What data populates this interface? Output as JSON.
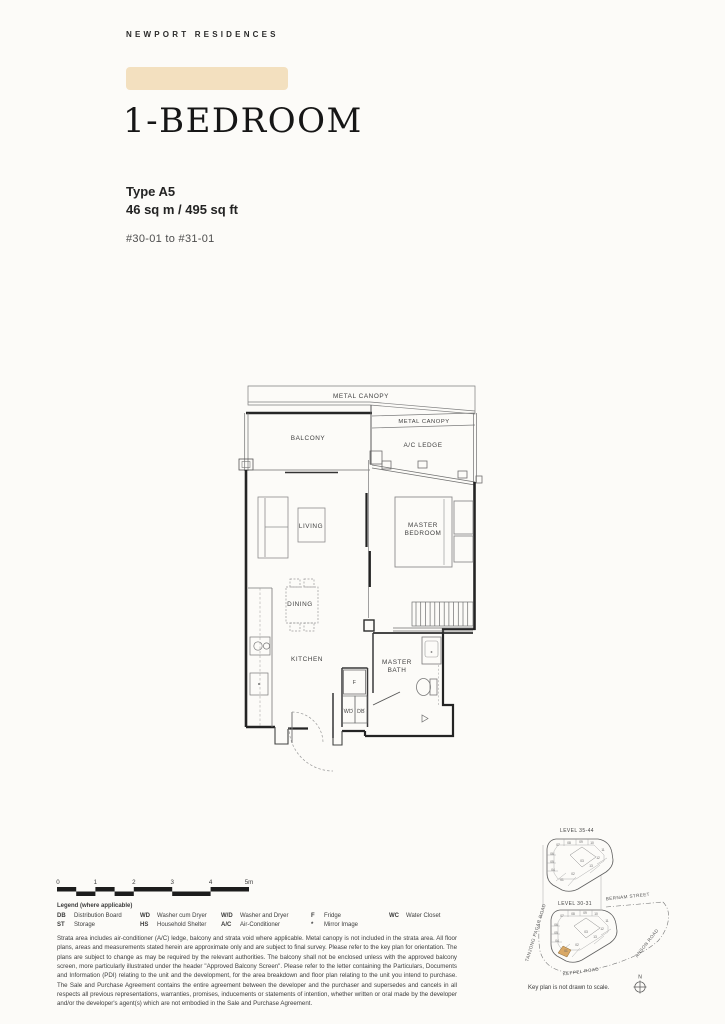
{
  "brand": "NEWPORT RESIDENCES",
  "unit": {
    "title": "1-BEDROOM",
    "type": "Type A5",
    "area": "46 sq m / 495 sq ft",
    "stacks": "#30-01 to #31-01"
  },
  "plan_labels": {
    "metal_canopy_top": "METAL CANOPY",
    "metal_canopy_2": "METAL CANOPY",
    "ac_ledge": "A/C LEDGE",
    "balcony": "BALCONY",
    "living": "LIVING",
    "master_bedroom_1": "MASTER",
    "master_bedroom_2": "BEDROOM",
    "dining": "DINING",
    "kitchen": "KITCHEN",
    "master_bath_1": "MASTER",
    "master_bath_2": "BATH",
    "fridge": "F",
    "wd": "WD",
    "db": "DB"
  },
  "scale": {
    "ticks": [
      "0",
      "1",
      "2",
      "3",
      "4",
      "5m"
    ]
  },
  "legend": {
    "title": "Legend (where applicable)",
    "entries": [
      {
        "abbr": "DB",
        "desc": "Distribution Board"
      },
      {
        "abbr": "ST",
        "desc": "Storage"
      },
      {
        "abbr": "WD",
        "desc": "Washer cum Dryer"
      },
      {
        "abbr": "HS",
        "desc": "Household Shelter"
      },
      {
        "abbr": "W/D",
        "desc": "Washer and Dryer"
      },
      {
        "abbr": "A/C",
        "desc": "Air-Conditioner"
      },
      {
        "abbr": "F",
        "desc": "Fridge"
      },
      {
        "abbr": "*",
        "desc": "Mirror Image"
      },
      {
        "abbr": "WC",
        "desc": "Water Closet"
      }
    ]
  },
  "disclaimer": "Strata area includes air-conditioner (A/C) ledge, balcony and strata void where applicable. Metal canopy is not included in the strata area. All floor plans, areas and measurements stated herein are approximate only and are subject to final survey. Please refer to the key plan for orientation. The plans are subject to change as may be required by the relevant authorities. The balcony shall not be enclosed unless with the approved balcony screen, more particularly illustrated under the header \"Approved Balcony Screen\". Please refer to the letter containing the Particulars, Documents and Information (PDI) relating to the unit and the development, for the area breakdown and floor plan relating to the unit you intend to purchase. The Sale and Purchase Agreement contains the entire agreement between the developer and the purchaser and supersedes and cancels in all respects all previous representations, warranties, promises, inducements or statements of intention, whether written or oral made by the developer and/or the developer's agent(s) which are not embodied in the Sale and Purchase Agreement.",
  "keyplan": {
    "upper_level": "LEVEL  35-44",
    "lower_level": "LEVEL  30-31",
    "streets": {
      "bernam": "BERNAM STREET",
      "tanjong_pagar": "TANJONG PAGAR ROAD",
      "anson": "ANSON ROAD",
      "keppel": "KEPPEL ROAD"
    },
    "note": "Key plan is not drawn to scale.",
    "compass_north": "N",
    "highlight_color": "#d9a865",
    "units": [
      {
        "n": "01",
        "x": 42,
        "y": 66
      },
      {
        "n": "02",
        "x": 53,
        "y": 60
      },
      {
        "n": "03",
        "x": 62,
        "y": 47
      },
      {
        "n": "04",
        "x": 33,
        "y": 56
      },
      {
        "n": "05",
        "x": 32,
        "y": 48
      },
      {
        "n": "06",
        "x": 32,
        "y": 40
      },
      {
        "n": "07",
        "x": 38,
        "y": 31
      },
      {
        "n": "08",
        "x": 49,
        "y": 29
      },
      {
        "n": "09",
        "x": 61,
        "y": 28
      },
      {
        "n": "10",
        "x": 72,
        "y": 29
      },
      {
        "n": "11",
        "x": 83,
        "y": 36
      },
      {
        "n": "12",
        "x": 78,
        "y": 44
      },
      {
        "n": "13",
        "x": 71,
        "y": 52
      }
    ]
  },
  "colors": {
    "accent_bar": "#f3e0bf",
    "highlight_unit": "#d9a865"
  }
}
